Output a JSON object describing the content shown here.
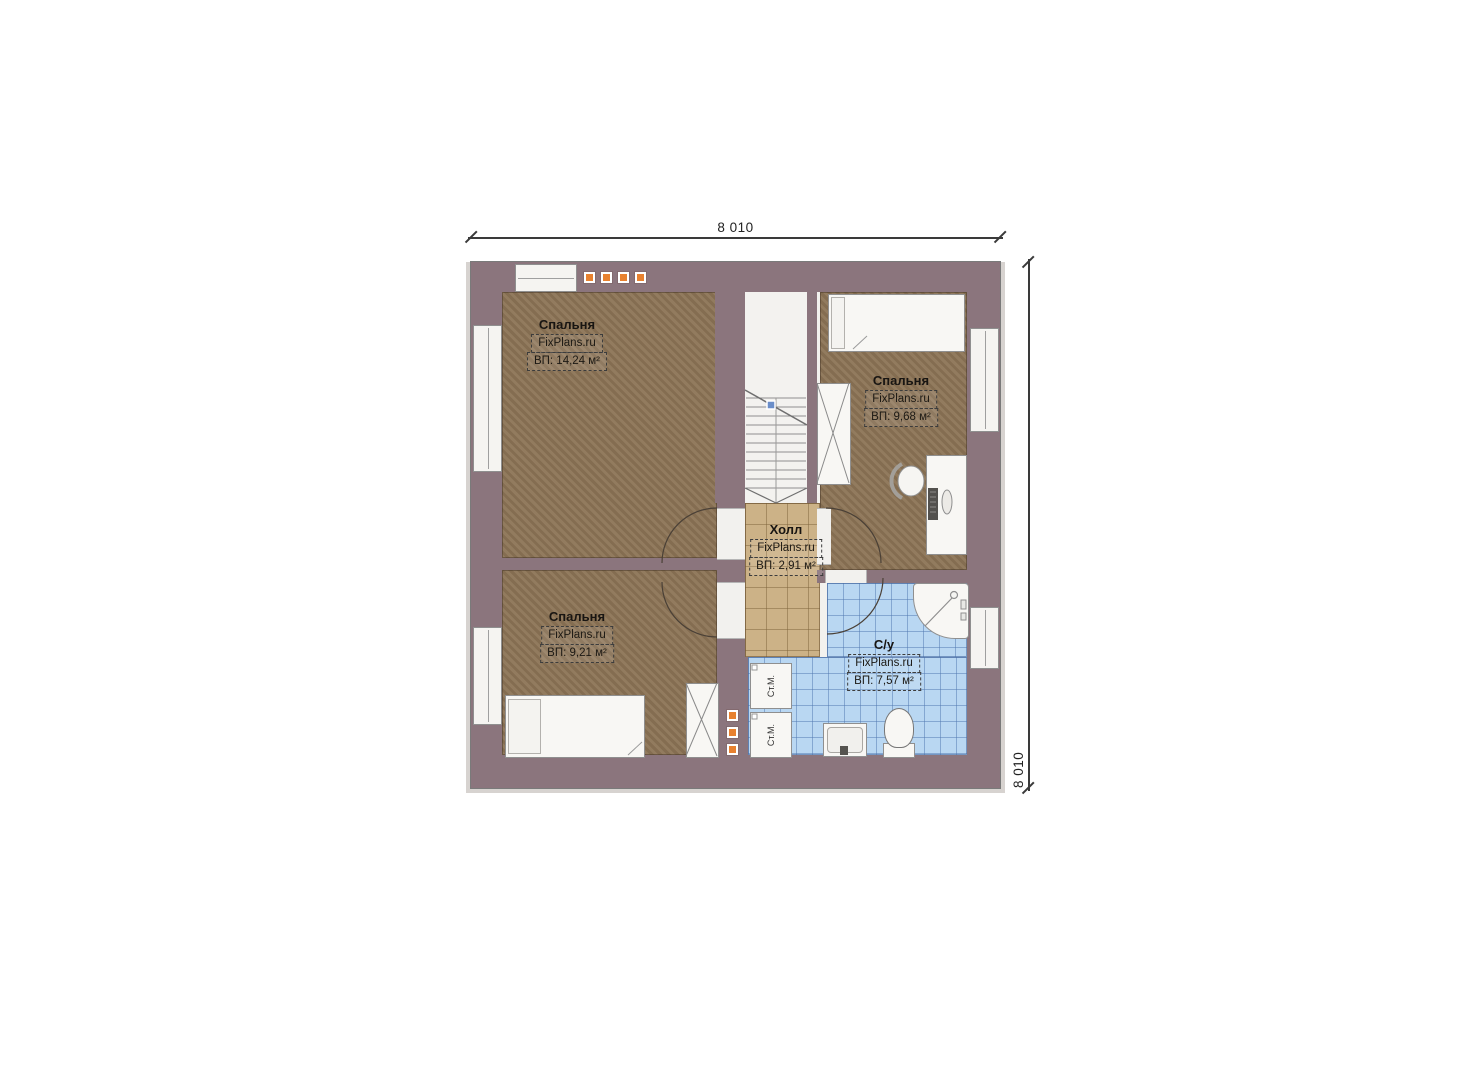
{
  "plan": {
    "dimension_top": "8 010",
    "dimension_right": "8 010",
    "rooms": [
      {
        "id": "bedroom-top-left",
        "name": "Спальня",
        "watermark": "FixPlans.ru",
        "area": "ВП: 14,24 м²"
      },
      {
        "id": "bedroom-right",
        "name": "Спальня",
        "watermark": "FixPlans.ru",
        "area": "ВП: 9,68 м²"
      },
      {
        "id": "hall",
        "name": "Холл",
        "watermark": "FixPlans.ru",
        "area": "ВП: 2,91 м²"
      },
      {
        "id": "bedroom-bottom-left",
        "name": "Спальня",
        "watermark": "FixPlans.ru",
        "area": "ВП: 9,21 м²"
      },
      {
        "id": "bathroom",
        "name": "С/у",
        "watermark": "FixPlans.ru",
        "area": "ВП: 7,57 м²"
      }
    ],
    "appliances": {
      "washing_machine": "Ст.М."
    },
    "colors": {
      "wall": "#8b757d",
      "bedroom_floor": "#8c7456",
      "hall_floor": "#ccb287",
      "bathroom_floor": "#b9d7f2",
      "roof_window_accent": "#e8812f"
    }
  }
}
